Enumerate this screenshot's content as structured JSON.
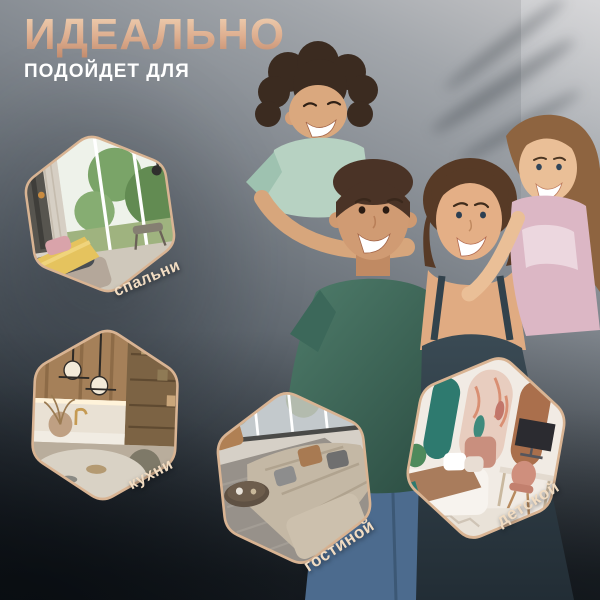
{
  "header": {
    "title": "ИДЕАЛЬНО",
    "subtitle": "ПОДОЙДЕТ ДЛЯ"
  },
  "hexagons": [
    {
      "id": "bedroom",
      "label": "спальни"
    },
    {
      "id": "kitchen",
      "label": "кухни"
    },
    {
      "id": "living",
      "label": "гостиной"
    },
    {
      "id": "children",
      "label": "детской"
    }
  ],
  "colors": {
    "title_gradient_top": "#f0d2b4",
    "title_gradient_bottom": "#c28b6d",
    "subtitle": "#ffffff",
    "label_text": "#f1dcc2",
    "hexagon_border": "#d9b493",
    "background_light": "#c7c7c9",
    "background_dark": "#161b21"
  }
}
